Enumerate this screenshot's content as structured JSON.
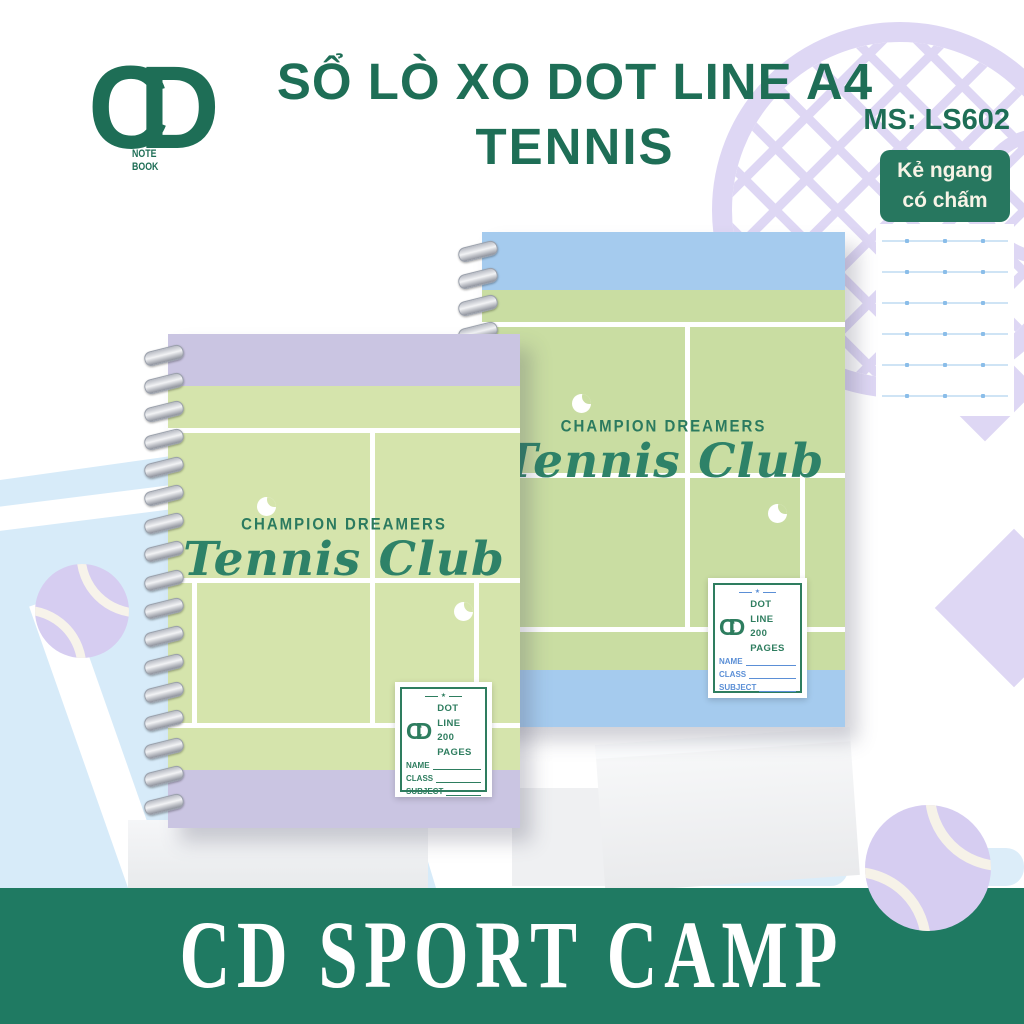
{
  "header": {
    "title_line1": "SỔ LÒ XO DOT LINE A4",
    "title_line2": "TENNIS",
    "product_code": "MS: LS602",
    "badge_line1": "Kẻ ngang",
    "badge_line2": "có chấm"
  },
  "logo": {
    "monogram": "CD",
    "note": "NOTE",
    "book": "BOOK"
  },
  "cover": {
    "tagline": "CHAMPION DREAMERS",
    "club_name": "Tennis Club"
  },
  "label": {
    "brand": "CD SPORT CAMP",
    "divider_star": "★",
    "spec_line1": "DOT LINE",
    "spec_line2": "200 PAGES",
    "fields": [
      "NAME",
      "CLASS",
      "SUBJECT"
    ]
  },
  "footer": {
    "brand": "CD SPORT CAMP"
  },
  "colors": {
    "brand_green": "#1e6e56",
    "footer_green": "#1f7a62",
    "badge_green": "#27775f",
    "cover_green_left": "#d5e4ac",
    "cover_green_right": "#c9dda2",
    "trim_lavender": "#cac5e2",
    "trim_blue": "#a5cbee",
    "label_blue": "#5b8fd6",
    "court_blue_bg": "#d7ebf9",
    "decor_lilac": "#ded7f4"
  }
}
